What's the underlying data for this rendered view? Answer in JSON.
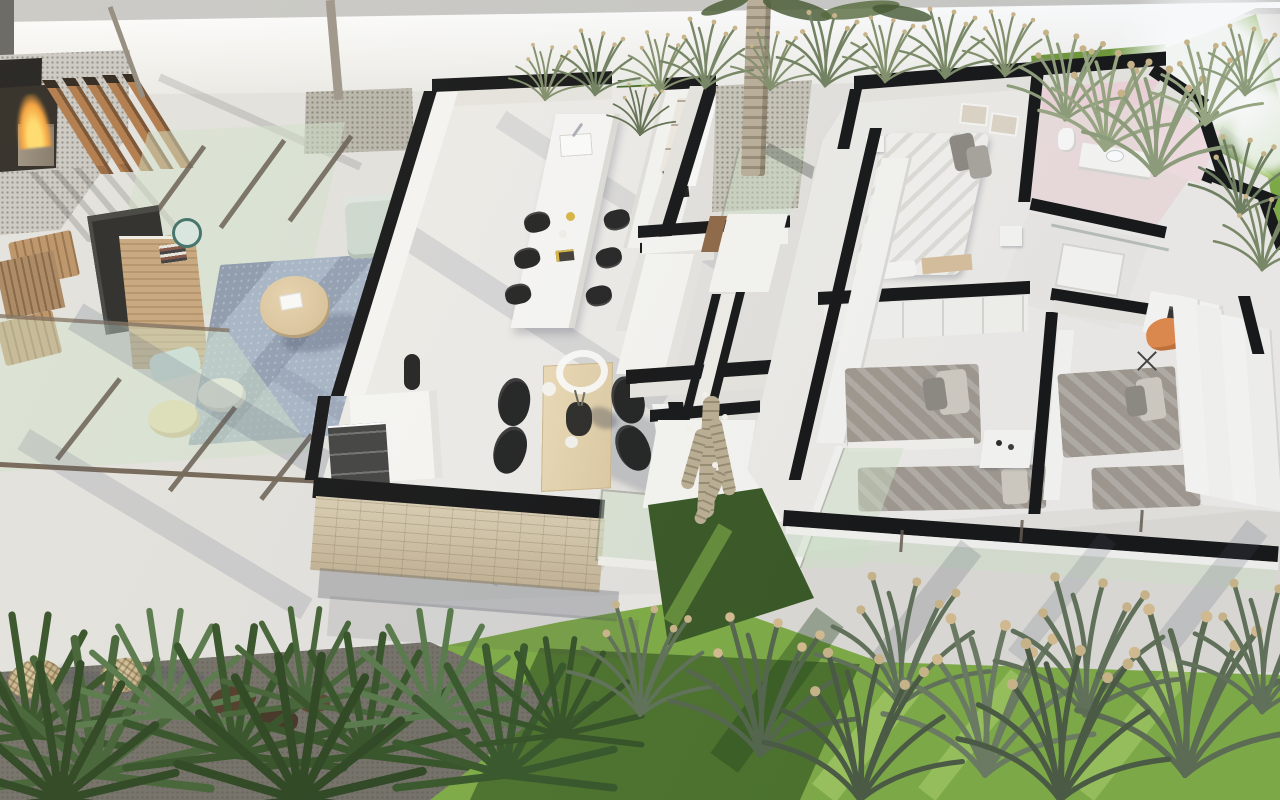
{
  "meta": {
    "title": "Aerial 3D cutaway floor-plan render of a modern single-storey villa",
    "width": 1280,
    "height": 800,
    "style": "photorealistic dollhouse render, walls cut flat with black caps"
  },
  "colors": {
    "base": "#e3e1dc",
    "fence-face": "#f3f2ee",
    "fence-top": "#c7c6c2",
    "wall-cap": "#0c0c0c",
    "wall-white": "#f6f5f1",
    "wall-shade": "#e7e4dd",
    "floor-light": "#edebe6",
    "floor-mid": "#e1ded8",
    "grass-sun": "#79a83c",
    "grass-mid": "#699431",
    "grass-dark": "#2f4f14",
    "grass-patch": "#31511a",
    "glass-mint": "#cfe2c6",
    "glass-frame": "#5e5346",
    "wood-slat": "#ad7341",
    "wood-slat-dark": "#6f4826",
    "wood-light": "#e4d0a9",
    "wood-mid": "#c5a277",
    "stone": "#cfc0a0",
    "rug-blue": "#a3b1c2",
    "sofa-sage": "#cdd8cd",
    "duvet-gray": "#9c9489",
    "pillow-light": "#cfc9bd",
    "bed-white": "#f3f1ec",
    "pink-wall": "#eed3d7",
    "pink-floor": "#ecdcda",
    "orange-accent": "#e08544",
    "black-furniture": "#1b1b19",
    "flame-orange": "#f59b30",
    "flame-yellow": "#ffd964",
    "gravel": "#c6c2b6",
    "pavers": "#c9c6c0",
    "trunk": "#b2a48e",
    "cactus-tan": "#b9ac8e",
    "wicker": "#c9b183",
    "shadow-blue": "#4b5569",
    "teal": "#37695f",
    "blue-cushion": "#c8dce2",
    "cream-pouf": "#e8d9a8",
    "path-white": "#e9e7e2",
    "pave-band": "#dcd9d3",
    "plant-dark": "#2c4a1c",
    "plant-mid": "#507341",
    "plant-gray": "#5a6b50",
    "seed-beige": "#c9b283",
    "fence-grass": "#7d8b64",
    "ground-dark": "#6e6a61",
    "door-wood": "#8a623e"
  },
  "scene": {
    "outdoor_terrace": [
      "wood-slat-screen",
      "fire-bowl",
      "outdoor-dark-kitchen",
      "concrete-pavers",
      "sun-loungers",
      "wood-deck",
      "glass-canopy",
      "glass-railing",
      "tv-panel",
      "wicker-console",
      "books",
      "round-mirror",
      "round-coffee-table",
      "blue-rug",
      "sage-sofa",
      "bookshelf",
      "floor-lamp",
      "poufs",
      "gravel-tree-bed",
      "thin-tree-trunks"
    ],
    "living_kitchen_wing": [
      "white-dining-island",
      "sink-faucet",
      "black-shell-chairs",
      "kitchen-galley",
      "cooktop",
      "open-shelves",
      "sideboard",
      "wood-dining-table",
      "table-wreath",
      "table-vase",
      "stone-feature-wall",
      "sliding-glass-door"
    ],
    "courtyard": [
      "palm-trunk",
      "palm-fronds",
      "gravel-patch",
      "glass-partition",
      "hallway",
      "interior-door"
    ],
    "bedroom_wing": [
      "master-bed",
      "gray-pillows",
      "wall-art",
      "wardrobe-row",
      "pink-bathroom",
      "vanity",
      "toilet",
      "shower-room",
      "shower-tray",
      "twin-beds",
      "nightstands",
      "desk",
      "laptop",
      "orange-swivel-chair",
      "sliding-wardrobe-panels",
      "south-window-band"
    ],
    "garden": [
      "boundary-fence-wall",
      "ornamental-grasses",
      "back-lawn",
      "east-lawn",
      "front-lawn",
      "white-paths",
      "paving-band",
      "foreground-palm-plants",
      "dry-grass-tufts",
      "wicker-lanterns",
      "dark-gravel-bed",
      "cactus-sculpture",
      "sun-flare"
    ]
  }
}
